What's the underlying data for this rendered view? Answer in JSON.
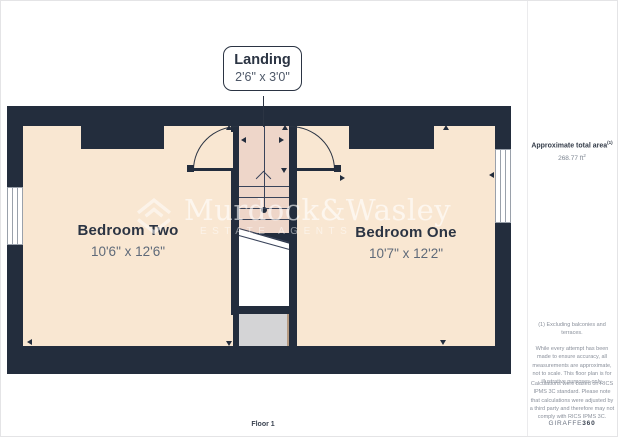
{
  "page": {
    "floor_label": "Floor 1"
  },
  "callout": {
    "title": "Landing",
    "dimensions": "2'6\" x 3'0\""
  },
  "rooms": [
    {
      "name": "Bedroom Two",
      "dimensions": "10'6\" x 12'6\""
    },
    {
      "name": "Bedroom One",
      "dimensions": "10'7\" x 12'2\""
    }
  ],
  "watermark": {
    "name": "Murdock&Wasley",
    "subtitle": "ESTATE AGENTS"
  },
  "sidebar": {
    "area_label": "Approximate total area",
    "area_label_note": "(1)",
    "area_value": "268.77 ft",
    "area_value_sup": "2",
    "footnote": "(1) Excluding balconies and terraces.",
    "disclaimer_accuracy": "While every attempt has been made to ensure accuracy, all measurements are approximate, not to scale. This floor plan is for illustrative purposes only.",
    "disclaimer_calculations": "Calculations were based on RICS IPMS 3C standard. Please note that calculations were adjusted by a third party and therefore may not comply with RICS IPMS 3C.",
    "brand_name": "GIRAFFE",
    "brand_suffix": "360"
  },
  "colors": {
    "wall": "#232d3d",
    "floor": "#f9e7d2",
    "landing": "#eed6c9",
    "understairs": "#d4d4d6",
    "text-dark": "#2b3443",
    "text-muted": "#5f6a79",
    "sidebar-text": "#8a909b",
    "divider": "#ebebed",
    "window-frame": "#9aa1ab"
  }
}
